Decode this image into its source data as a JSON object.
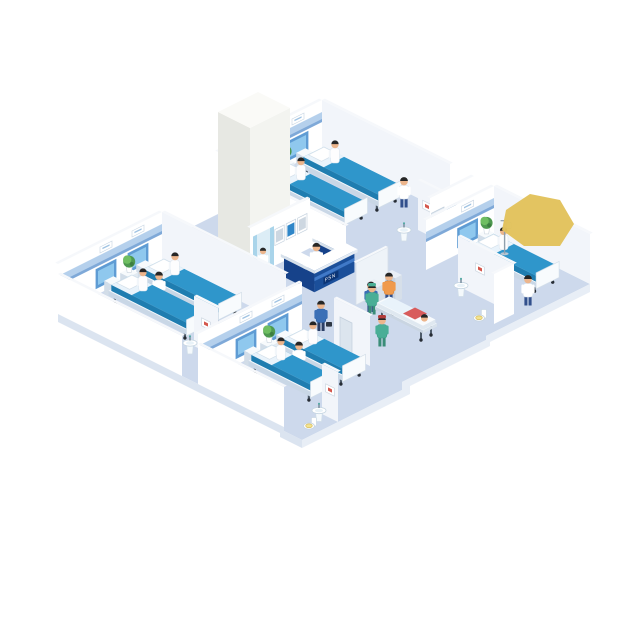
{
  "scene": {
    "title": "Isometric hospital floor illustration",
    "background": "#ffffff"
  },
  "reception": {
    "sign_text": "PSN"
  },
  "palette": {
    "floor": "#cdd9ec",
    "floorEdgeSE": "#e8eef6",
    "floorEdgeSW": "#dbe4f0",
    "wallSE": "#ffffff",
    "wallSW": "#f2f5fa",
    "wallFront": "#ffffff",
    "wallTop": "#f6f8fb",
    "band": "#b5d0ec",
    "bandDark": "#7fa9d8",
    "panel": "#5f9cd4",
    "panelLight": "#8fc8ee",
    "mattress": "#2f96cb",
    "mattressSide": "#1f7db0",
    "sheet": "#e9f3fb",
    "bedBaseTop": "#f3f8fc",
    "bedBaseSE": "#dde8f2",
    "bedBaseSW": "#c9d7e6",
    "leg": "#4d5a68",
    "deskFront": "#1b4f9a",
    "deskSide": "#16428a",
    "deskTop": "#2c63b0",
    "deskBand": "#4079c8",
    "counter": "#ffffff",
    "signBg": "#0c3576",
    "screenBlue": "#2f86c8",
    "screenGray": "#cdd7e1",
    "plantDark": "#4e9950",
    "plantLight": "#6fbe62",
    "scrub": "#49ae96",
    "scrubDark": "#3a8d78",
    "skin": "#ecb58c",
    "hair": "#262626",
    "door": "#dce5ee",
    "toiletSeat": "#f2e391",
    "blob": "#e2c25c",
    "towerSE": "#f3f4f0",
    "towerSW": "#e7e8e3",
    "towerTop": "#fafaf7",
    "elevator": "#dcedf6",
    "elevatorPanel": "#a9d4ea",
    "shirtOrange": "#f09a4c",
    "shirtBlue": "#3a6fb6",
    "pants": "#32508c",
    "red": "#d85c5c",
    "artRed": "#d4574c"
  },
  "inventory": {
    "wards": [
      {
        "id": "ward-top",
        "beds": 2,
        "patients": 2,
        "staff": 1,
        "plants": 1
      },
      {
        "id": "ward-right",
        "beds": 1,
        "patients": 1,
        "staff": 1,
        "plants": 1,
        "equipment": [
          "iv-stand"
        ]
      },
      {
        "id": "ward-left",
        "beds": 2,
        "patients": 2,
        "staff": 1,
        "plants": 1
      },
      {
        "id": "ward-bottom",
        "beds": 2,
        "patients": 2,
        "staff": 1,
        "plants": 1
      }
    ],
    "bathrooms": [
      {
        "id": "bath-top",
        "fixtures": [
          "sink",
          "wall-art"
        ]
      },
      {
        "id": "bath-right",
        "fixtures": [
          "sink",
          "toilet",
          "wall-art"
        ]
      },
      {
        "id": "bath-left",
        "fixtures": [
          "sink",
          "wall-art"
        ]
      },
      {
        "id": "bath-bottom",
        "fixtures": [
          "sink",
          "toilet",
          "wall-art"
        ]
      }
    ],
    "lobby": {
      "reception_desk": 1,
      "receptionist": 1,
      "wall_monitors": 3,
      "check_in_kiosks": 2,
      "kiosk_users": 2,
      "elevator": 1,
      "elevator_occupant": 1,
      "stretcher": 1,
      "stretcher_patient": 1,
      "surgeon": 1,
      "walking_nurse": 1,
      "visitor_with_briefcase": 1
    },
    "overlay": {
      "yellow_blob": 1
    }
  }
}
